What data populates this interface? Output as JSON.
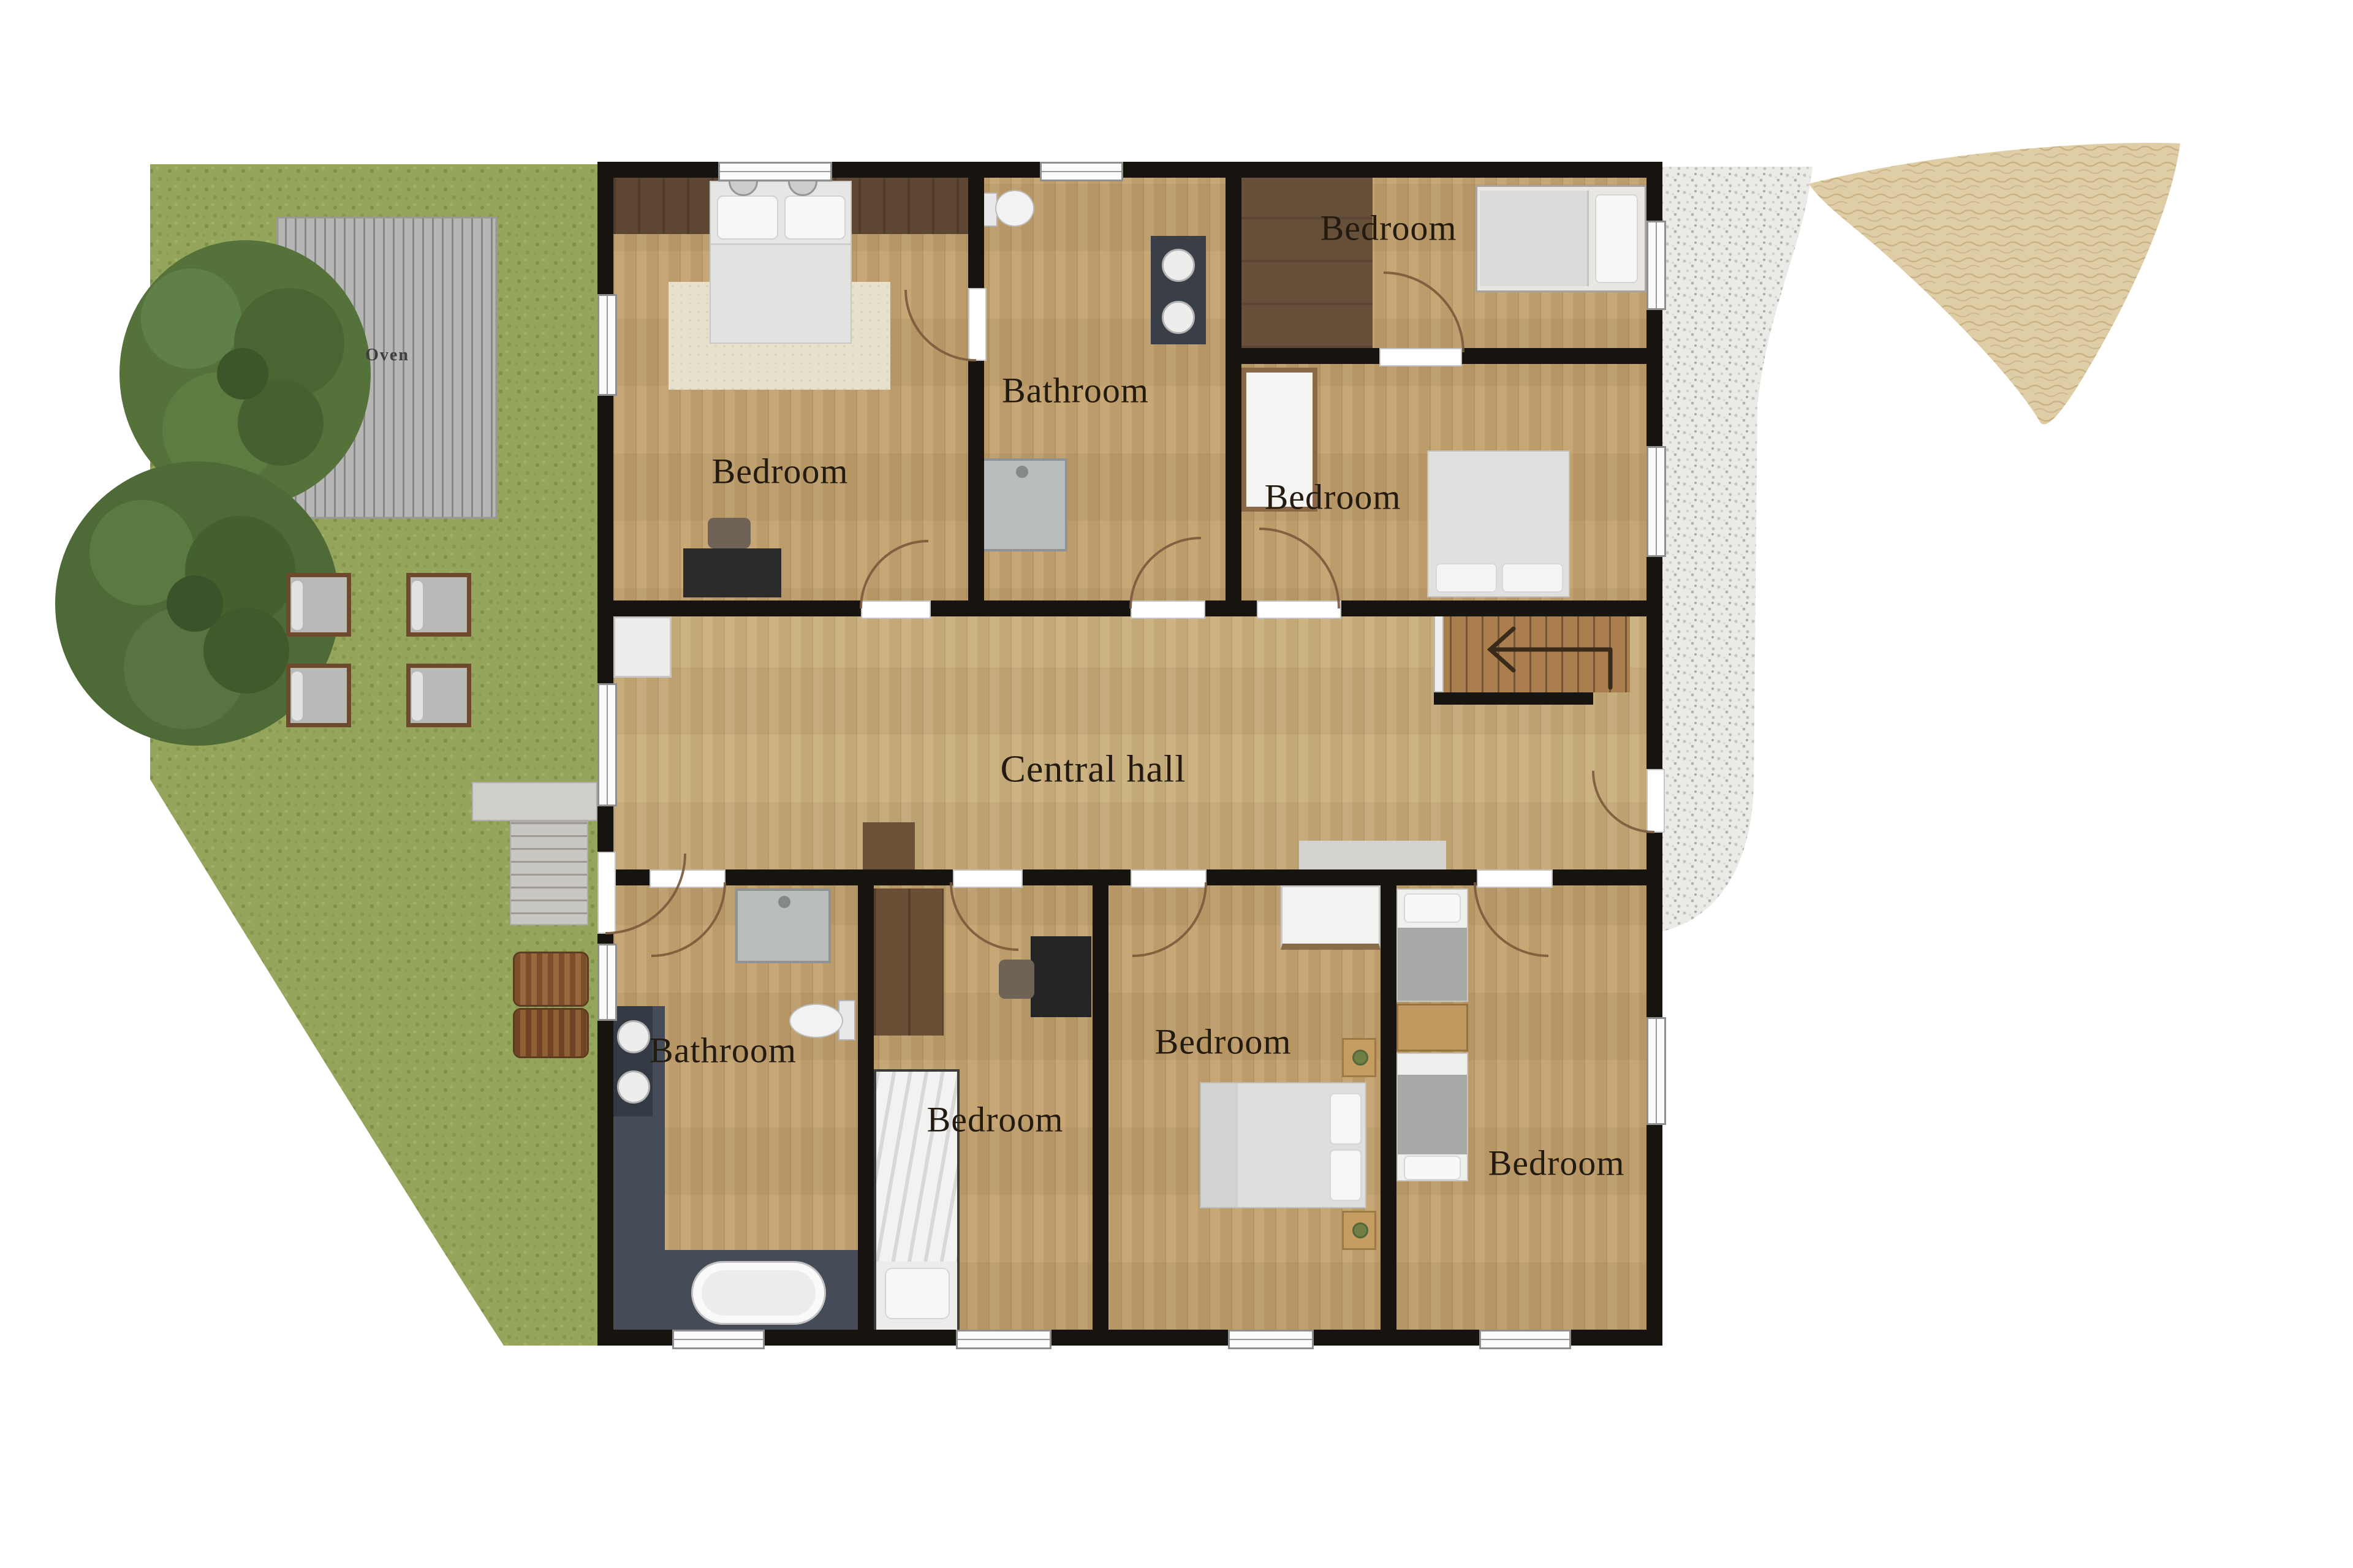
{
  "plan": {
    "type": "floor_plan",
    "labels": {
      "oven": "Oven",
      "bedroom_master": "Bedroom",
      "bathroom_top": "Bathroom",
      "bedroom_top_right": "Bedroom",
      "bedroom_mid_right": "Bedroom",
      "central_hall": "Central hall",
      "bathroom_bottom": "Bathroom",
      "bedroom_bottom_small": "Bedroom",
      "bedroom_bottom_double": "Bedroom",
      "bedroom_bottom_right": "Bedroom"
    },
    "colors": {
      "wall": "#17130f",
      "wood": "#c2a06b",
      "wood_hall": "#c9ad79",
      "grass": "#95a65c",
      "gravel": "#eae8e4",
      "sand": "#ddcba3",
      "accent_brown": "#5e4732",
      "tile_dark": "#454c57"
    }
  }
}
